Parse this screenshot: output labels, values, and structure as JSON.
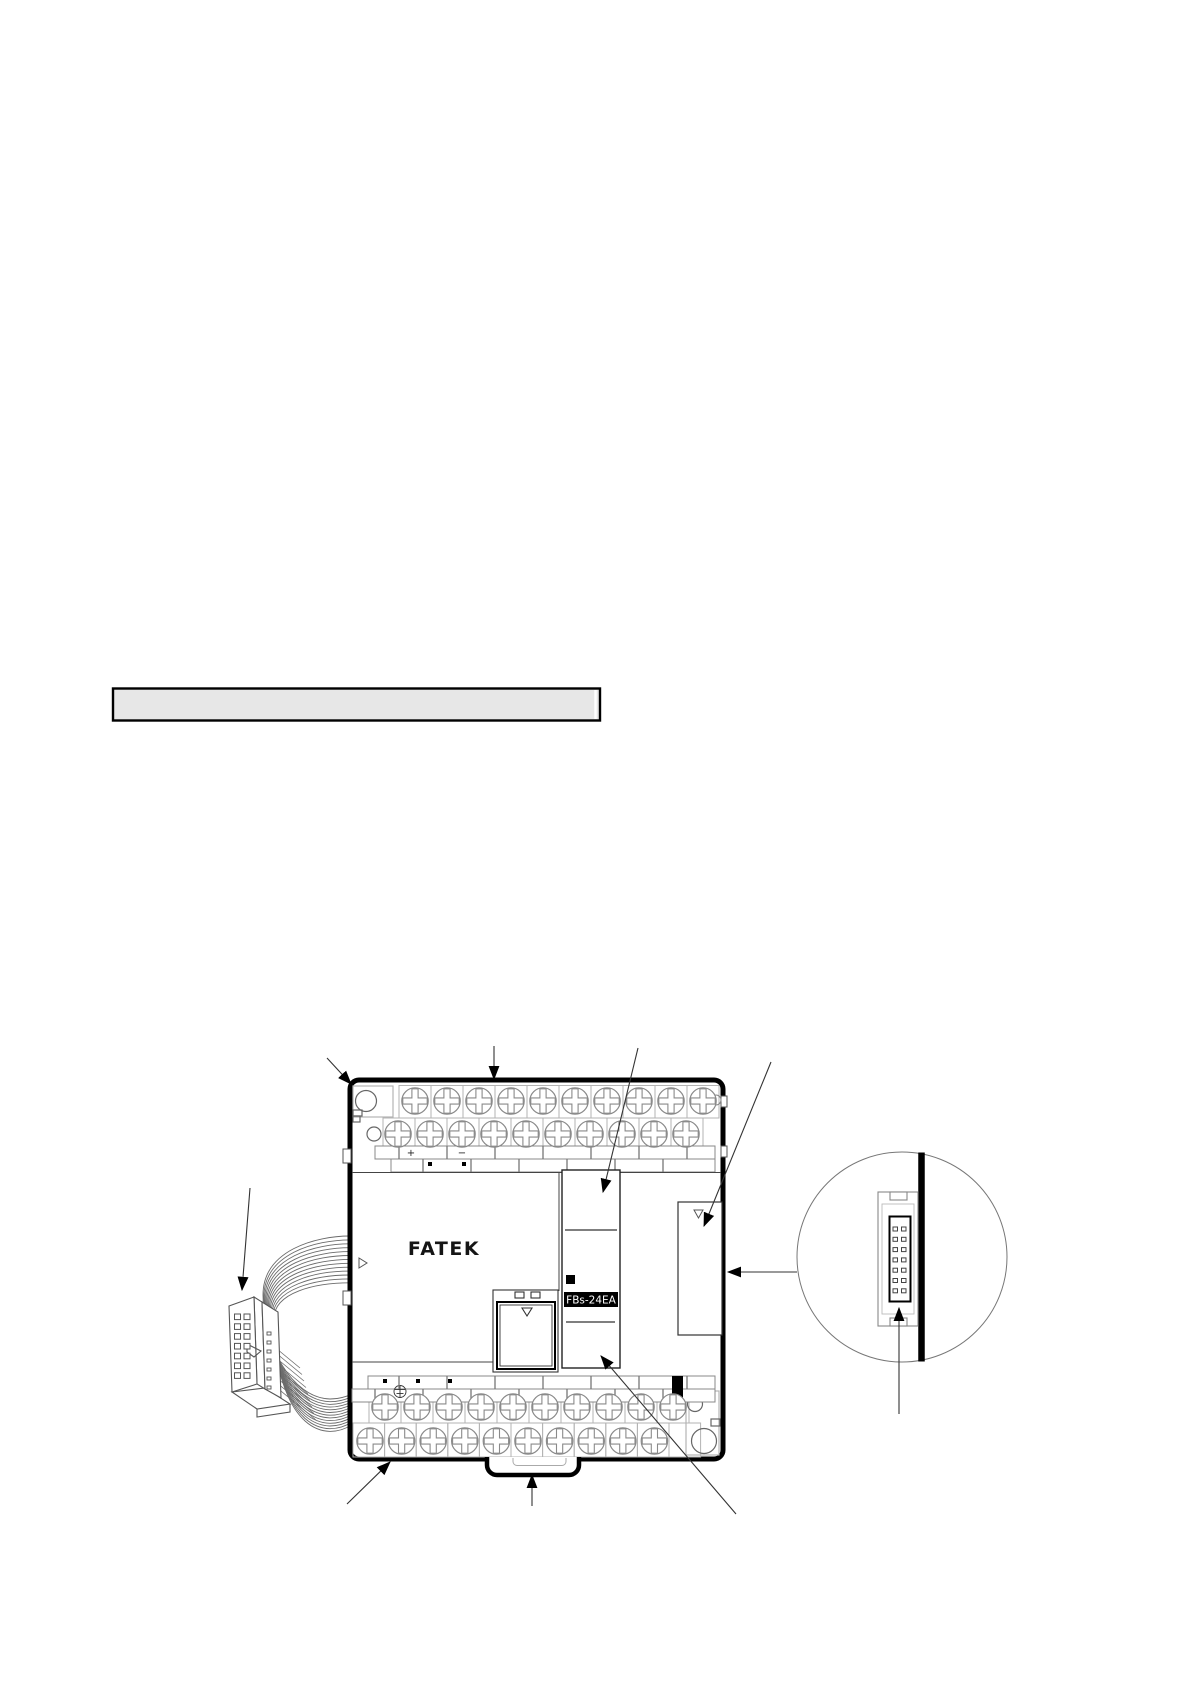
{
  "document": {
    "kind": "product-manual-page",
    "background_color": "#ffffff"
  },
  "heading_bar": {
    "fill_color": "#e7e7e7",
    "border_color": "#000000"
  },
  "diagram": {
    "brand_label": "FATEK",
    "model_label": "FBs-24EA",
    "terminal_plus_label": "+",
    "terminal_minus_label": "−",
    "outline_color": "#000000",
    "detail_color": "#777777"
  }
}
